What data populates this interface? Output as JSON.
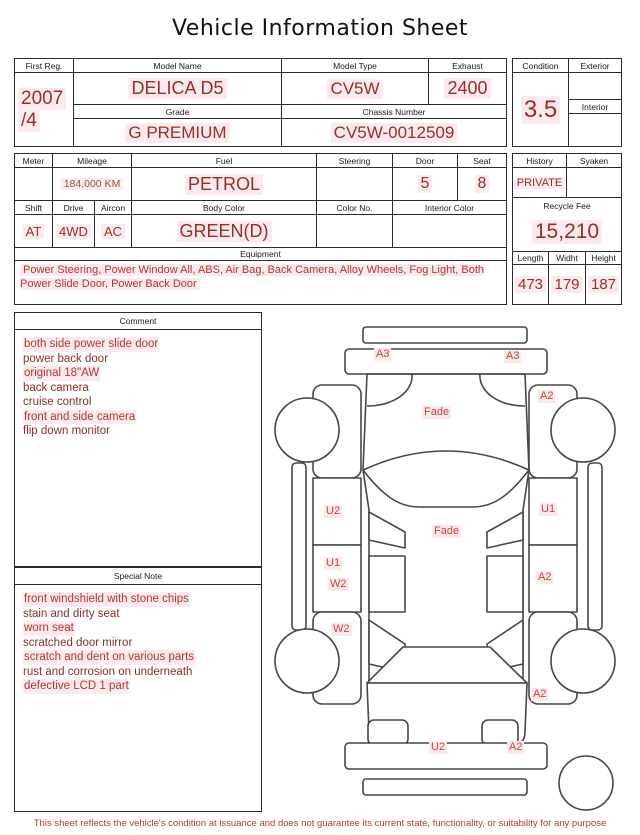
{
  "title": "Vehicle Information Sheet",
  "header_table": {
    "first_reg": {
      "label": "First Reg.",
      "line1": "2007",
      "line2": "/4"
    },
    "model_name": {
      "label": "Model Name",
      "value": "DELICA D5"
    },
    "model_type": {
      "label": "Model Type",
      "value": "CV5W"
    },
    "exhaust": {
      "label": "Exhaust",
      "value": "2400"
    },
    "grade": {
      "label": "Grade",
      "value": "G PREMIUM"
    },
    "chassis_number": {
      "label": "Chassis Number",
      "value": "CV5W-0012509"
    }
  },
  "condition_panel": {
    "condition": {
      "label": "Condition",
      "value": "3.5"
    },
    "exterior": {
      "label": "Exterior",
      "value": ""
    },
    "interior": {
      "label": "Interior",
      "value": ""
    }
  },
  "spec_table": {
    "meter": {
      "label": "Meter",
      "value": ""
    },
    "mileage": {
      "label": "Mileage",
      "value": "184,000 KM"
    },
    "fuel": {
      "label": "Fuel",
      "value": "PETROL"
    },
    "steering": {
      "label": "Steering",
      "value": ""
    },
    "door": {
      "label": "Door",
      "value": "5"
    },
    "seat": {
      "label": "Seat",
      "value": "8"
    },
    "shift": {
      "label": "Shift",
      "value": "AT"
    },
    "drive": {
      "label": "Drive",
      "value": "4WD"
    },
    "aircon": {
      "label": "Aircon",
      "value": "AC"
    },
    "body_color": {
      "label": "Body Color",
      "value": "GREEN(D)"
    },
    "color_no": {
      "label": "Color No.",
      "value": ""
    },
    "interior_color": {
      "label": "Interior Color",
      "value": ""
    },
    "equipment": {
      "label": "Equipment",
      "value": "Power Steering, Power Window  All, ABS, Air Bag, Back Camera, Alloy Wheels, Fog Light, Both Power Slide Door, Power Back Door"
    }
  },
  "history_panel": {
    "history": {
      "label": "History",
      "value": "PRIVATE"
    },
    "syaken": {
      "label": "Syaken",
      "value": ""
    },
    "recycle_fee": {
      "label": "Recycle Fee",
      "value": "15,210"
    },
    "length": {
      "label": "Length",
      "value": "473"
    },
    "width": {
      "label": "Widht",
      "value": "179"
    },
    "height": {
      "label": "Height",
      "value": "187"
    }
  },
  "comment": {
    "label": "Comment",
    "items": [
      "both side power slide door",
      "power back door",
      "original 18\"AW",
      "back camera",
      "cruise control",
      "front and side camera",
      "flip down monitor"
    ]
  },
  "special_note": {
    "label": "Special Note",
    "items": [
      "front windshield with stone chips",
      "stain and dirty seat",
      "worn seat",
      "scratched door mirror",
      "scratch and dent on various parts",
      "rust and corrosion on underneath",
      "defective LCD 1 part"
    ]
  },
  "diagram": {
    "labels": [
      {
        "text": "A3"
      },
      {
        "text": "A3"
      },
      {
        "text": "A2"
      },
      {
        "text": "Fade"
      },
      {
        "text": "U2"
      },
      {
        "text": "U1"
      },
      {
        "text": "Fade"
      },
      {
        "text": "U1"
      },
      {
        "text": "W2"
      },
      {
        "text": "A2"
      },
      {
        "text": "W2"
      },
      {
        "text": "A2"
      },
      {
        "text": "U2"
      },
      {
        "text": "A2"
      }
    ]
  },
  "disclaimer": "This sheet reflects the vehicle's condition at issuance and does not guarantee its current state, functionality, or suitability for any purpose",
  "colors": {
    "value_red": "#9c2d24",
    "marker_red": "#c1473e",
    "highlight_pink": "#fceaee",
    "border": "#2b2b2b"
  }
}
